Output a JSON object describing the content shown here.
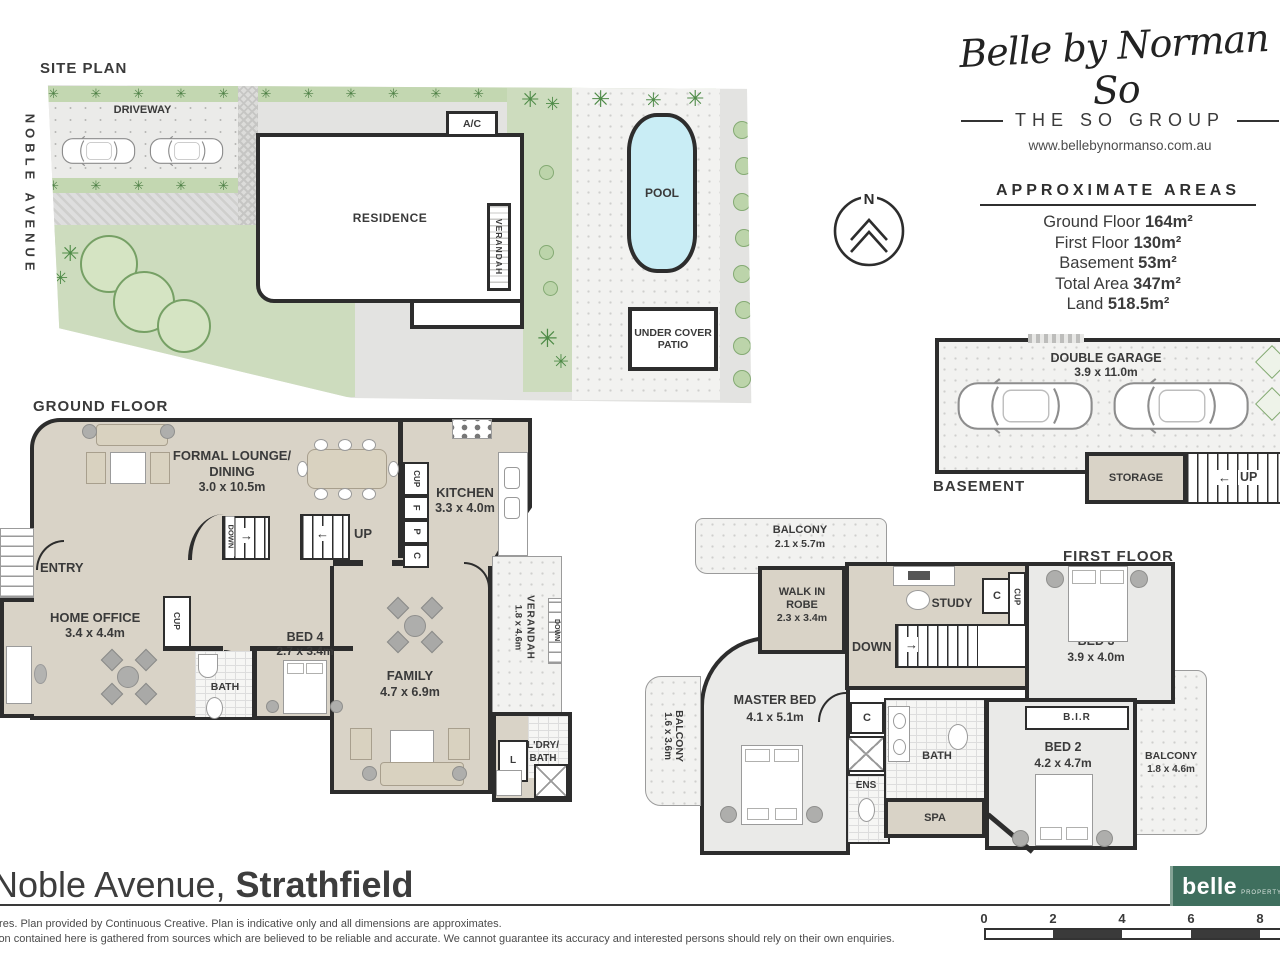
{
  "branding": {
    "logo_script": "Belle by Norman So",
    "group_name": "THE SO GROUP",
    "website": "www.bellebynormanso.com.au"
  },
  "areas": {
    "title": "APPROXIMATE AREAS",
    "rows": [
      {
        "label": "Ground Floor",
        "value": "164m²"
      },
      {
        "label": "First Floor",
        "value": "130m²"
      },
      {
        "label": "Basement",
        "value": "53m²"
      },
      {
        "label": "Total Area",
        "value": "347m²"
      },
      {
        "label": "Land",
        "value": "518.5m²"
      }
    ]
  },
  "compass": {
    "north": "N"
  },
  "icons": {
    "arrow_right": "→",
    "arrow_left": "←"
  },
  "site_plan": {
    "title": "SITE PLAN",
    "street_name": "NOBLE AVENUE",
    "driveway": "DRIVEWAY",
    "residence": "RESIDENCE",
    "ac": "A/C",
    "verandah": "VERANDAH",
    "pool": "POOL",
    "patio_line1": "UNDER COVER",
    "patio_line2": "PATIO",
    "hedge_glyphs": "✳ ✳ ✳ ✳ ✳ ✳ ✳ ✳ ✳ ✳ ✳ ✳ ✳ ✳ ✳ ✳ ✳ ✳ ✳ ✳ ✳ ✳",
    "palm_glyph": "✳"
  },
  "ground_floor": {
    "title": "GROUND FLOOR",
    "lounge_line1": "FORMAL LOUNGE/",
    "lounge_line2": "DINING",
    "lounge_dims": "3.0 x 10.5m",
    "kitchen": "KITCHEN",
    "kitchen_dims": "3.3 x 4.0m",
    "cup1": "CUP",
    "f": "F",
    "p": "P",
    "c": "C",
    "up": "UP",
    "down": "DOWN",
    "entry": "ENTRY",
    "home_office": "HOME OFFICE",
    "home_office_dims": "3.4 x 4.4m",
    "cup2": "CUP",
    "bath": "BATH",
    "bed4": "BED 4",
    "bed4_dims": "2.7 x 3.4m",
    "family": "FAMILY",
    "family_dims": "4.7 x 6.9m",
    "verandah": "VERANDAH",
    "verandah_dims": "1.8 x 4.6m",
    "verandah_down": "DOWN",
    "ldry_line1": "L'DRY/",
    "ldry_line2": "BATH",
    "l": "L"
  },
  "first_floor": {
    "title": "FIRST FLOOR",
    "balcony_top": "BALCONY",
    "balcony_top_dims": "2.1 x 5.7m",
    "wir_line1": "WALK IN",
    "wir_line2": "ROBE",
    "wir_dims": "2.3 x 3.4m",
    "study": "STUDY",
    "down": "DOWN",
    "c1": "C",
    "cup": "CUP",
    "bed3": "BED 3",
    "bed3_dims": "3.9 x 4.0m",
    "master": "MASTER BED",
    "master_dims": "4.1 x 5.1m",
    "balcony_left": "BALCONY",
    "balcony_left_dims": "1.6 x 3.6m",
    "c2": "C",
    "ens": "ENS",
    "bath": "BATH",
    "spa": "SPA",
    "bed2": "BED 2",
    "bed2_dims": "4.2 x 4.7m",
    "bir": "B.I.R",
    "balcony_right": "BALCONY",
    "balcony_right_dims": "1.8 x 4.6m"
  },
  "basement": {
    "title": "BASEMENT",
    "garage": "DOUBLE GARAGE",
    "garage_dims": "3.9 x 11.0m",
    "storage": "STORAGE",
    "up": "UP"
  },
  "footer": {
    "address_regular": "Noble Avenue, ",
    "address_bold": "Strathfield",
    "disclaimer_line1": "tres. Plan provided by Continuous Creative. Plan is indicative only and all dimensions are approximates.",
    "disclaimer_line2": "ion contained here is gathered from sources which are believed to be reliable and accurate. We cannot guarantee its accuracy and interested persons should rely on their own enquiries."
  },
  "belle_logo": {
    "name": "belle",
    "sub": "PROPERTY"
  },
  "scale_bar": {
    "ticks": [
      "0",
      "2",
      "4",
      "6",
      "8"
    ]
  }
}
